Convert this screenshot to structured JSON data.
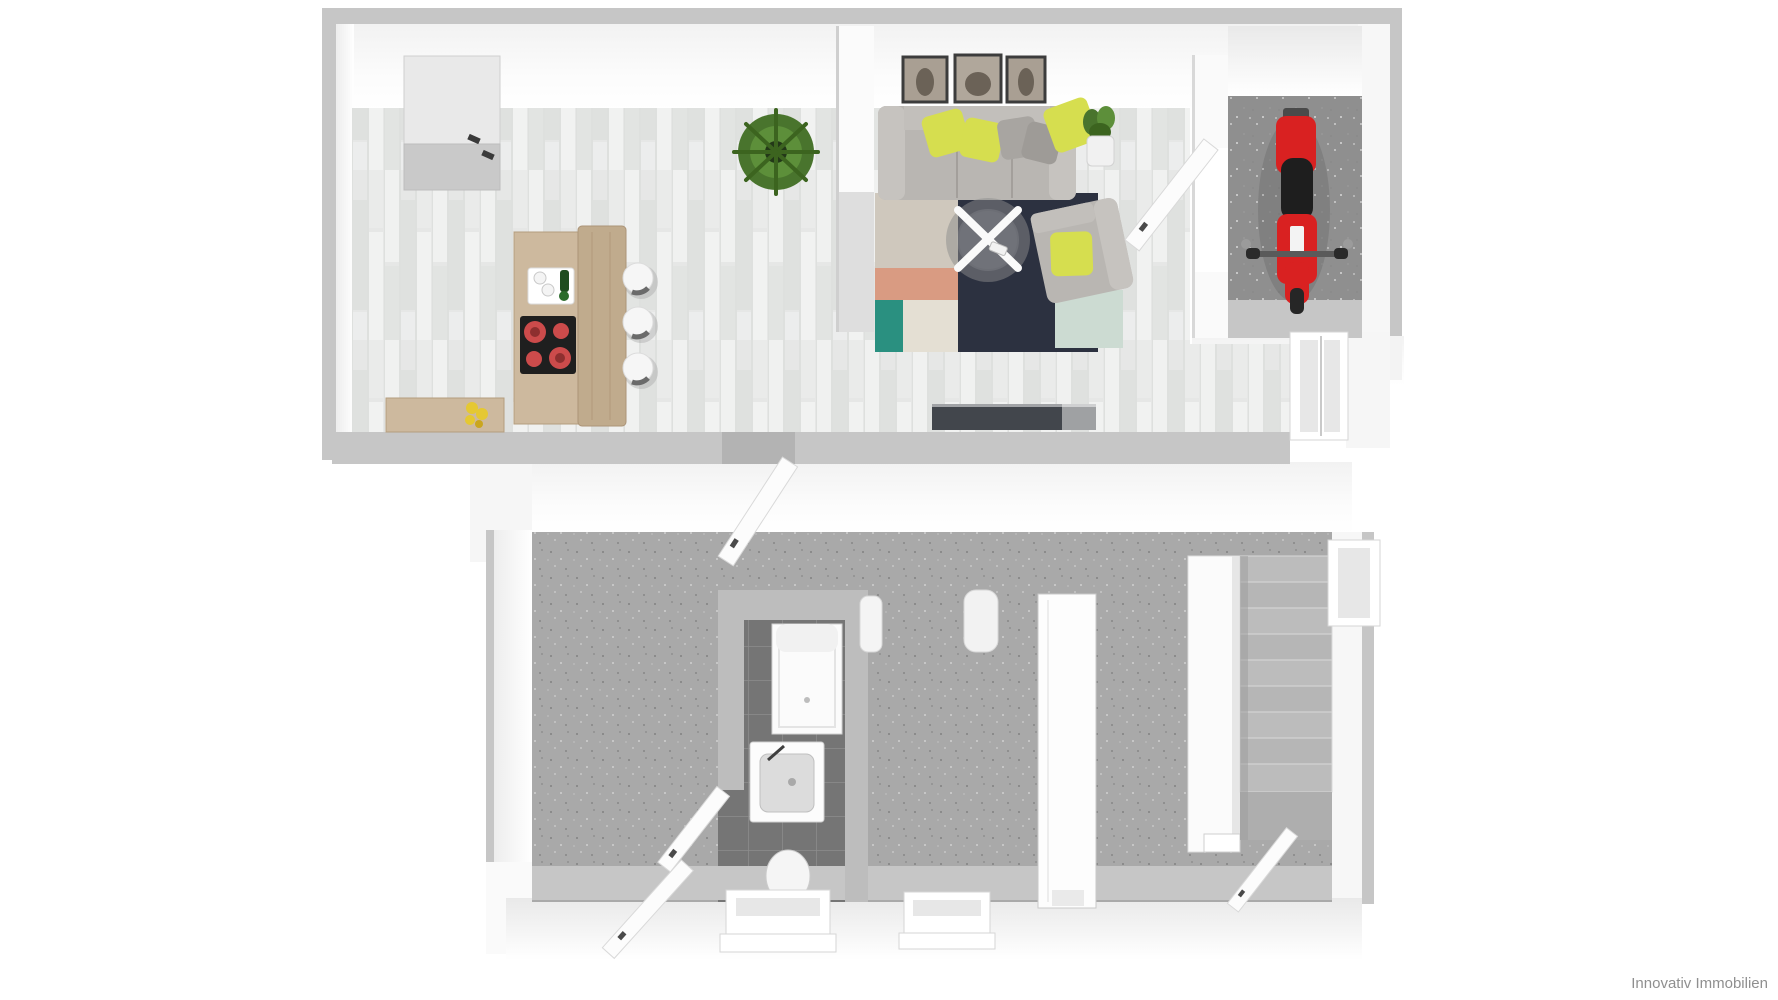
{
  "watermark": "Innovativ Immobilien",
  "plan": {
    "type": "3d-floor-plan-top-view",
    "rooms": [
      {
        "name": "kitchen-dining",
        "floor": "whitewashed-wood"
      },
      {
        "name": "living-room",
        "floor": "whitewashed-wood-with-rugs"
      },
      {
        "name": "storage-room-with-moped",
        "floor": "gray-concrete"
      },
      {
        "name": "basement-room-left",
        "floor": "gray-concrete"
      },
      {
        "name": "hallway-lower",
        "floor": "gray-concrete"
      },
      {
        "name": "bathroom",
        "floor": "dark-gray-tiles"
      },
      {
        "name": "stair-hall",
        "floor": "gray-concrete"
      }
    ],
    "furniture": [
      "tall-cabinet",
      "kitchen-island-with-cooktop",
      "bar-stools",
      "serving-tray",
      "fern-plant",
      "flower-pot",
      "wall-pictures",
      "sofa-with-pillows",
      "coffee-table",
      "armchair",
      "potted-plant",
      "tv-lowboard",
      "area-rugs",
      "red-moped",
      "shower-tray",
      "sink-vanity",
      "toilet",
      "staircase",
      "open-doors",
      "windows"
    ]
  },
  "colors": {
    "floor_wood": "#e6e7e6",
    "floor_concrete": "#a9a9a9",
    "floor_garage": "#8f8f8f",
    "tile_dark": "#757575",
    "wall_top": "#c4c4c4",
    "moped_red": "#d92121",
    "moped_seat": "#1e1e1e",
    "pillow_yellow": "#d6de4f",
    "sofa_gray": "#b9b6b2",
    "rug_navy": "#2c3140",
    "rug_teal": "#2a9080",
    "rug_salmon": "#d99b82",
    "rug_beige": "#cfc8bd",
    "rug_cream": "#e4dfd3",
    "rug_mint": "#ccdbd2",
    "burner_red": "#cc4b4b",
    "cooktop_black": "#1f1f1f",
    "counter_wood": "#cdb99e",
    "counter_wood_dark": "#c0ab8d",
    "plant_green": "#49742d",
    "plant_green_light": "#5d8f3a",
    "flower_yellow": "#e5c832",
    "lowboard_dark": "#42464c"
  }
}
